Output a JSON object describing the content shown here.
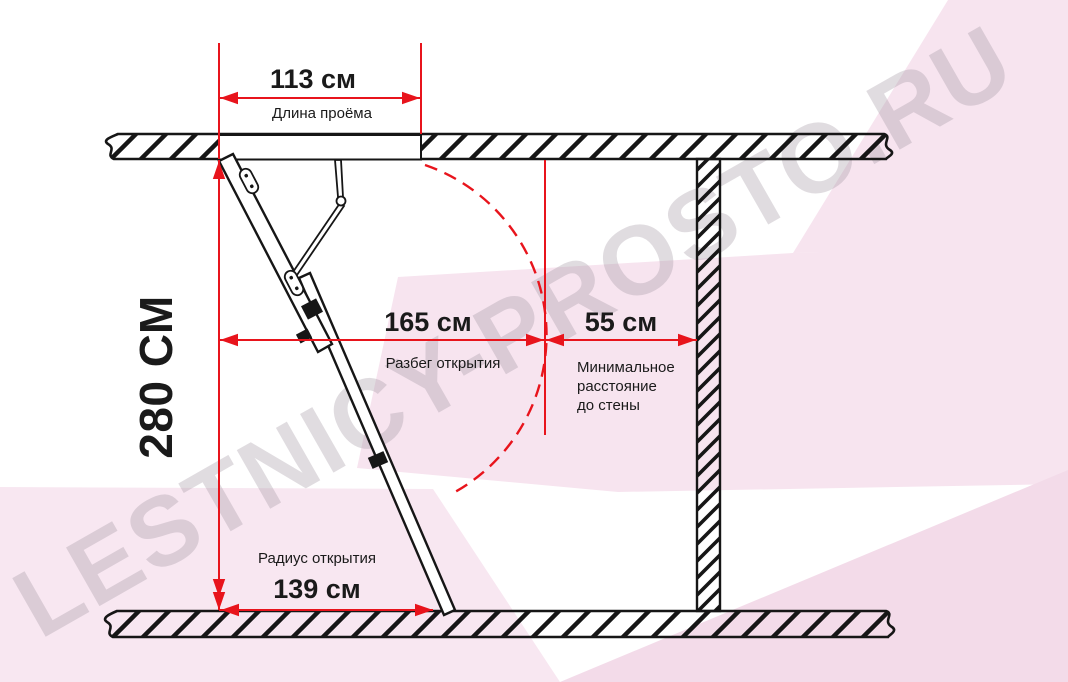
{
  "watermark": {
    "text": "LESTNICY-PROSTO.RU"
  },
  "colors": {
    "accent_red": "#e8141c",
    "ink": "#161616",
    "pink": "#f7e4ef",
    "pink_deep": "#f3dbe9",
    "watermark_gray": "#9b8f9b"
  },
  "dimensions": {
    "opening_length": {
      "value": "113 см",
      "label": "Длина проёма"
    },
    "floor_height": {
      "value": "280 СМ"
    },
    "opening_run": {
      "value": "165 см",
      "label": "Разбег открытия"
    },
    "min_wall_distance": {
      "value": "55 см",
      "label_lines": [
        "Минимальное",
        "расстояние",
        "до стены"
      ]
    },
    "opening_radius": {
      "value": "139 см",
      "label": "Радиус открытия"
    }
  }
}
